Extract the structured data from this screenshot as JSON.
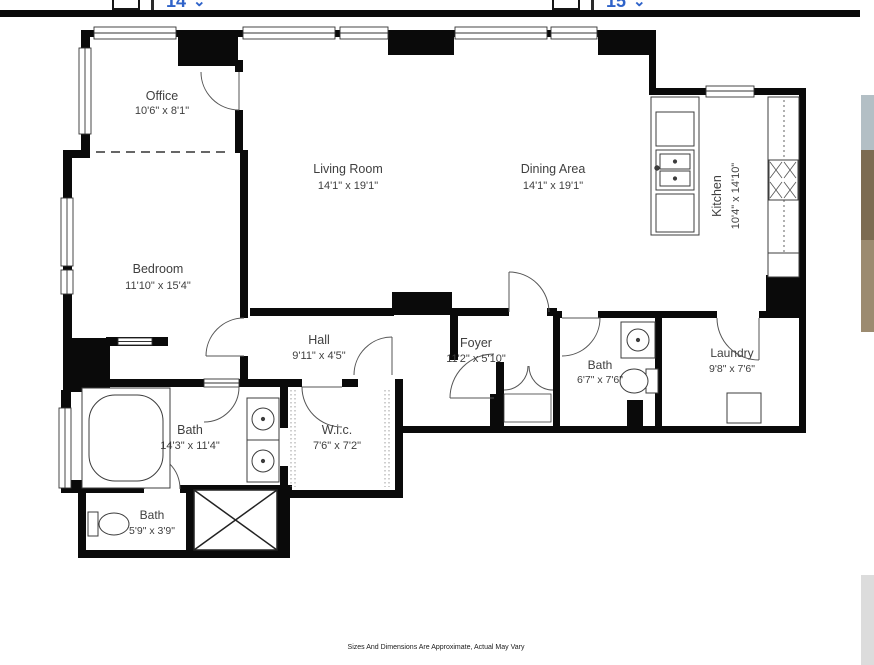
{
  "toolbar": {
    "page_selector_left": {
      "value": "14",
      "chevron": "⌄"
    },
    "page_selector_right": {
      "value": "15",
      "chevron": "⌄"
    }
  },
  "floorplan": {
    "rooms": {
      "office": {
        "name": "Office",
        "dims": "10'6\" x 8'1\""
      },
      "living_room": {
        "name": "Living Room",
        "dims": "14'1\" x 19'1\""
      },
      "dining_area": {
        "name": "Dining Area",
        "dims": "14'1\" x 19'1\""
      },
      "kitchen": {
        "name": "Kitchen",
        "dims": "10'4\" x 14'10\""
      },
      "bedroom": {
        "name": "Bedroom",
        "dims": "11'10\" x 15'4\""
      },
      "hall": {
        "name": "Hall",
        "dims": "9'11\" x 4'5\""
      },
      "foyer": {
        "name": "Foyer",
        "dims": "11'2\" x 5'10\""
      },
      "bath_guest": {
        "name": "Bath",
        "dims": "6'7\" x 7'6\""
      },
      "laundry": {
        "name": "Laundry",
        "dims": "9'8\" x 7'6\""
      },
      "bath_main": {
        "name": "Bath",
        "dims": "14'3\" x 11'4\""
      },
      "wic": {
        "name": "W.i.c.",
        "dims": "7'6\" x 7'2\""
      },
      "bath_small": {
        "name": "Bath",
        "dims": "5'9\" x 3'9\""
      }
    },
    "disclaimer": "Sizes And Dimensions Are Approximate, Actual May Vary",
    "colors": {
      "wall": "#0a0a0a",
      "selector_blue": "#2f63c9"
    }
  }
}
